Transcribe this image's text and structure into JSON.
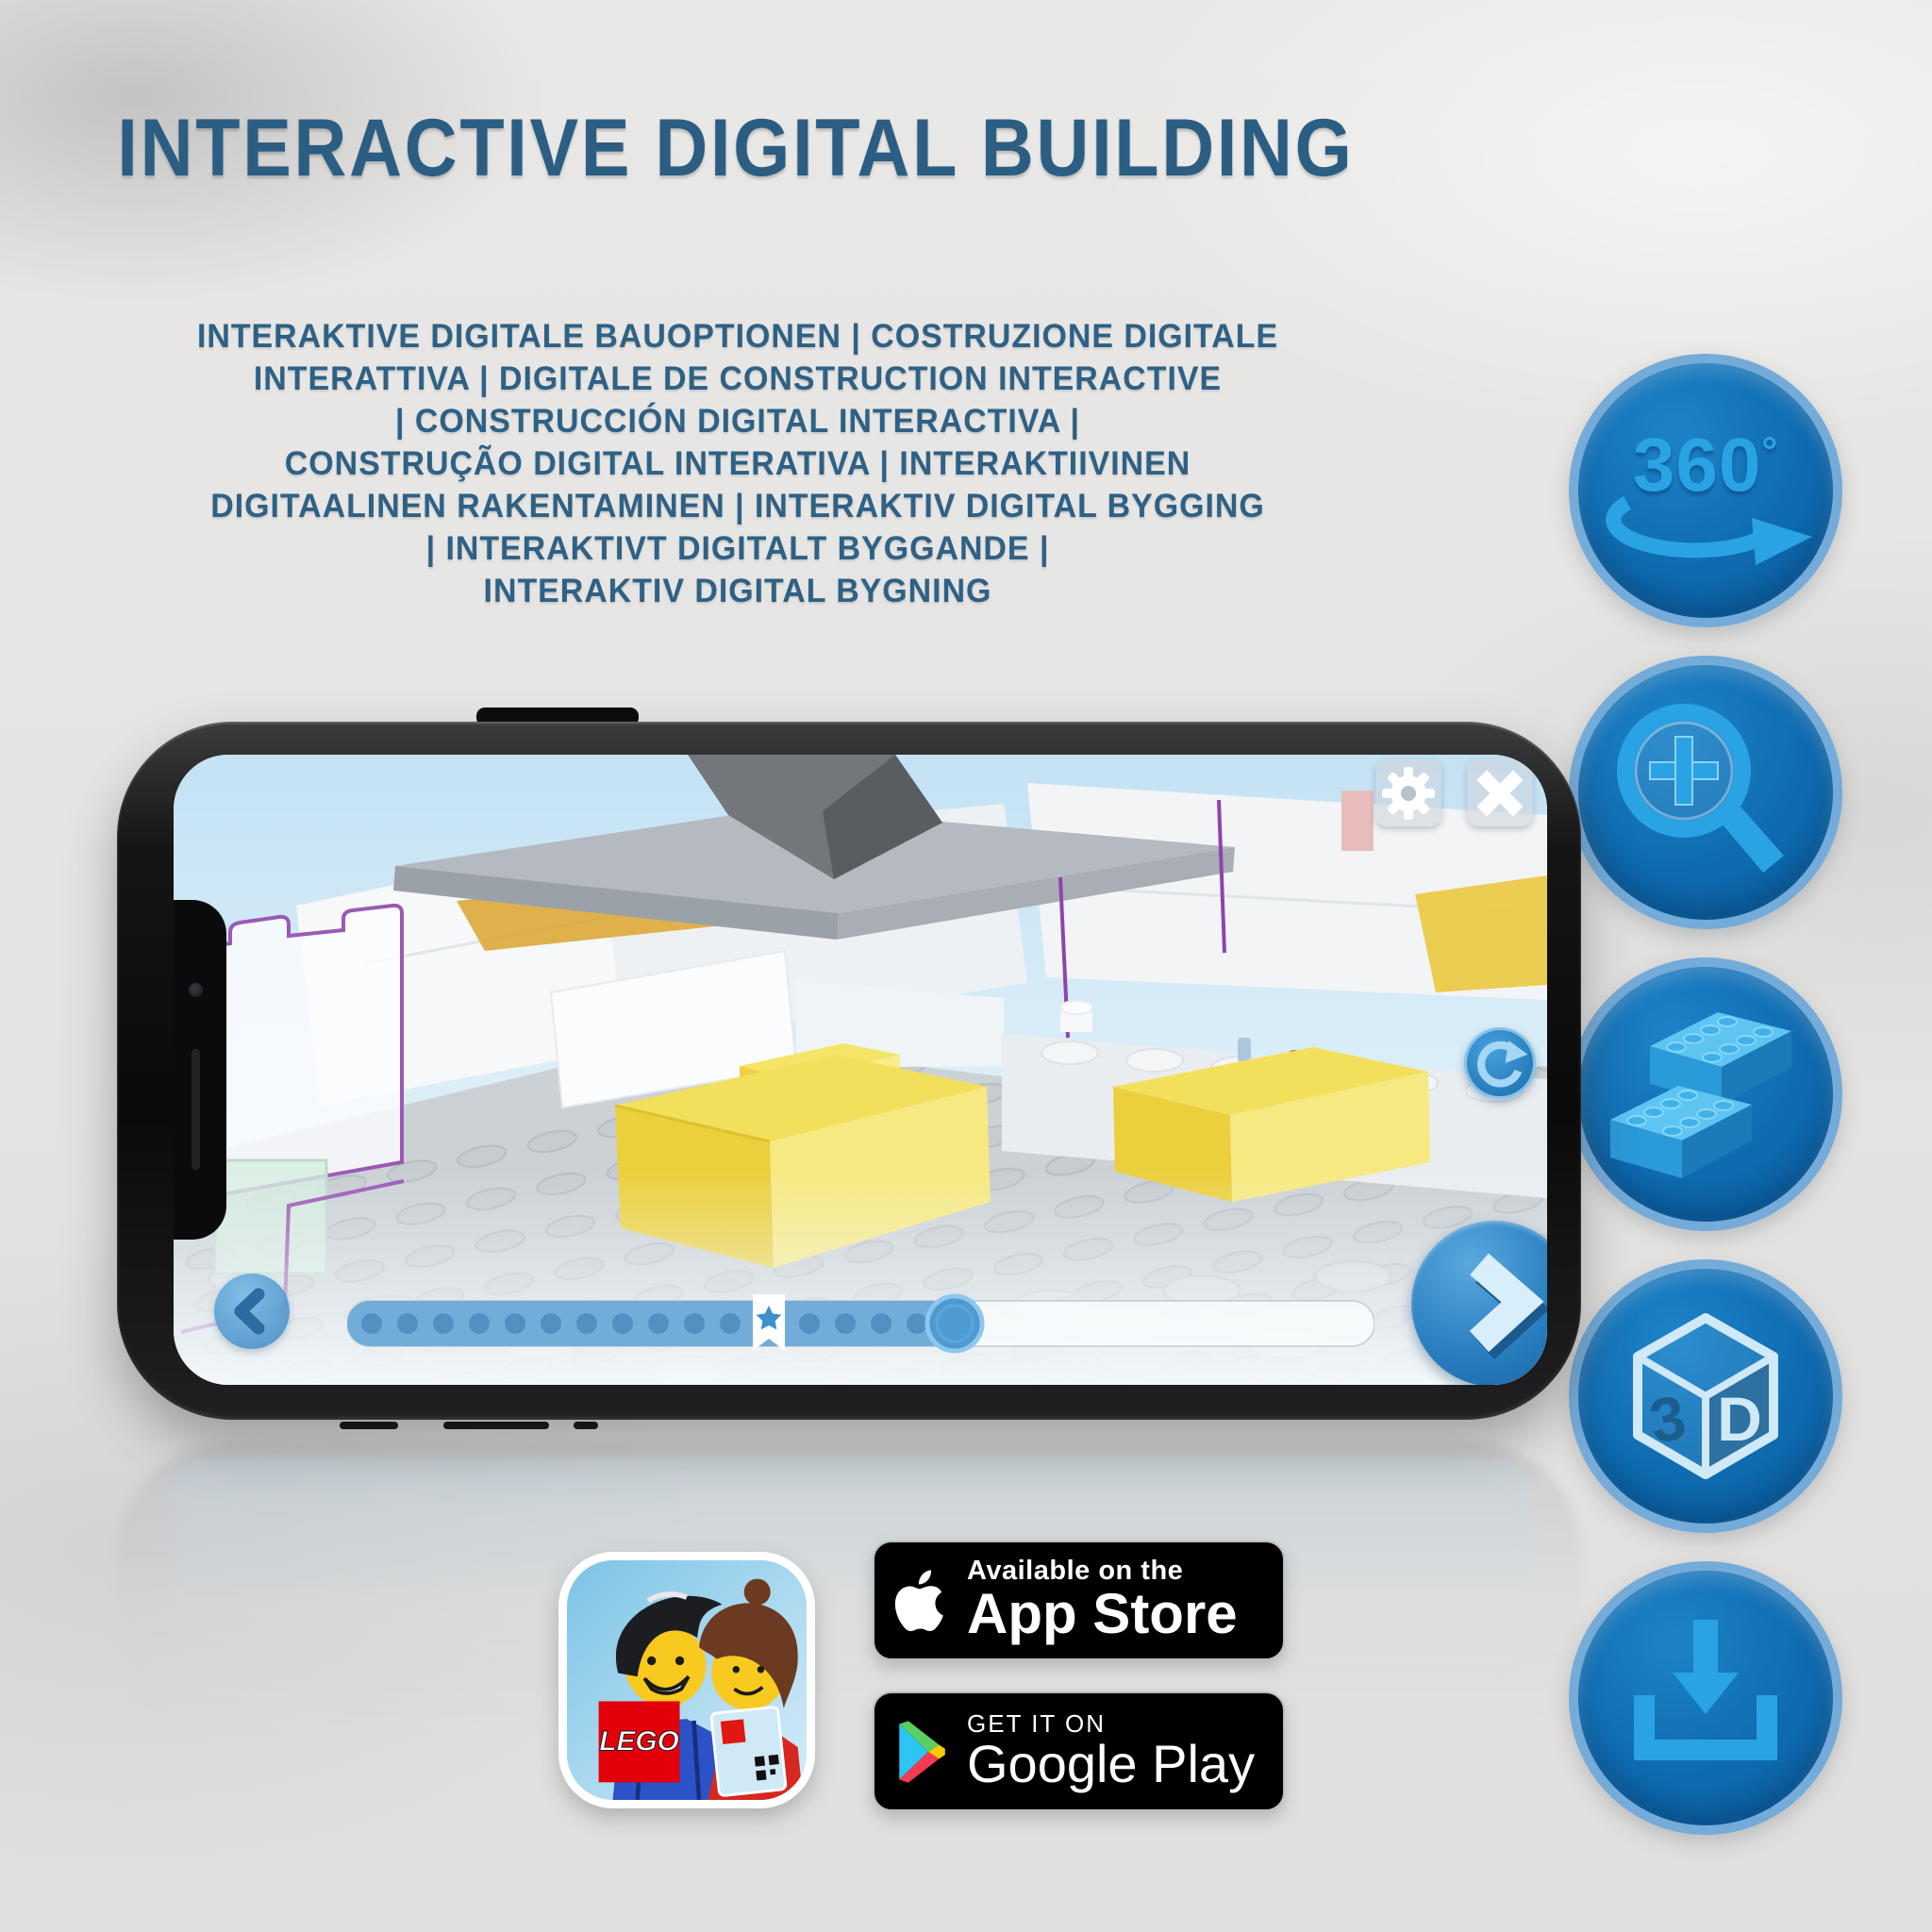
{
  "header": {
    "title": "INTERACTIVE DIGITAL BUILDING"
  },
  "subtitle": {
    "lines": [
      "INTERAKTIVE DIGITALE BAUOPTIONEN | COSTRUZIONE DIGITALE",
      "INTERATTIVA | DIGITALE DE CONSTRUCTION INTERACTIVE",
      "| CONSTRUCCIÓN DIGITAL INTERACTIVA |",
      "CONSTRUÇÃO DIGITAL INTERATIVA | INTERAKTIIVINEN",
      "DIGITAALINEN RAKENTAMINEN | INTERAKTIV DIGITAL BYGGING",
      "| INTERAKTIVT DIGITALT BYGGANDE |",
      "INTERAKTIV DIGITAL BYGNING"
    ]
  },
  "feature_icons": [
    {
      "id": "rotate-360",
      "label": "360",
      "degree": "°"
    },
    {
      "id": "zoom-in"
    },
    {
      "id": "lego-bricks"
    },
    {
      "id": "view-3d",
      "left_label": "3",
      "right_label": "D"
    },
    {
      "id": "download"
    }
  ],
  "phone": {
    "screen": {
      "stud_embossing": "LEGO",
      "progress": {
        "filled_ratio": 0.59,
        "bookmark_ratio": 0.41,
        "dot_count": 16
      }
    }
  },
  "badges": {
    "app_icon": {
      "logo_text": "LEGO"
    },
    "app_store": {
      "tagline": "Available on the",
      "store_name": "App Store"
    },
    "google_play": {
      "tagline": "GET IT ON",
      "store_name": "Google Play"
    }
  },
  "colors": {
    "heading_blue": "#2b5e82",
    "icon_circle_fill": "#0f6bb0",
    "icon_circle_ring": "#74abd8",
    "icon_glyph_blue": "#29a3e3",
    "highlight_yellow": "#eed64a",
    "outline_purple": "#9b59b6",
    "ui_button_blue": "#4a95cf"
  }
}
